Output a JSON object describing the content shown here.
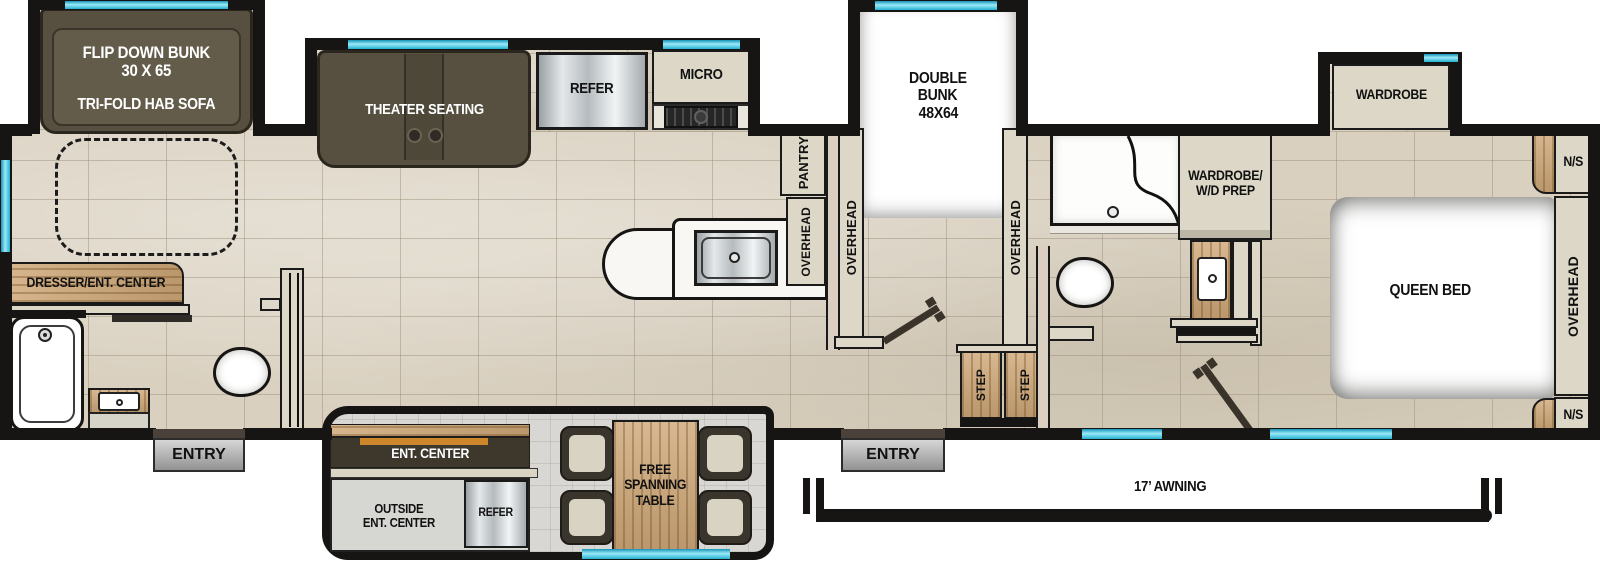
{
  "colors": {
    "wall": "#161514",
    "window_accent": "#24b0d2",
    "floor": "#d9d0bf",
    "tv_strip_orange": "#cd862c"
  },
  "labels": {
    "rear_slide": {
      "bunk_line1": "FLIP DOWN BUNK",
      "bunk_line2": "30 X 65",
      "sofa": "TRI-FOLD HAB SOFA"
    },
    "kitchen_slide": {
      "theater": "THEATER SEATING",
      "refer": "REFER",
      "micro": "MICRO"
    },
    "kitchen": {
      "pantry": "PANTRY",
      "overhead": "OVERHEAD"
    },
    "bunk_room": {
      "line1": "DOUBLE",
      "line2": "BUNK",
      "line3": "48X64",
      "overhead_left": "OVERHEAD",
      "overhead_right": "OVERHEAD",
      "step_left": "STEP",
      "step_right": "STEP"
    },
    "living": {
      "dresser": "DRESSER/ENT. CENTER"
    },
    "mid_bath": {
      "wardrobe_line1": "WARDROBE/",
      "wardrobe_line2": "W/D PREP"
    },
    "bedroom": {
      "wardrobe_slide": "WARDROBE",
      "bed": "QUEEN BED",
      "overhead": "OVERHEAD",
      "ns_top": "N/S",
      "ns_bottom": "N/S"
    },
    "dinette_slide": {
      "ent_center": "ENT. CENTER",
      "outside_line1": "OUTSIDE",
      "outside_line2": "ENT. CENTER",
      "refer": "REFER",
      "table_line1": "FREE",
      "table_line2": "SPANNING",
      "table_line3": "TABLE"
    },
    "exterior": {
      "entry_rear": "ENTRY",
      "entry_main": "ENTRY",
      "awning": "17’ AWNING"
    }
  }
}
